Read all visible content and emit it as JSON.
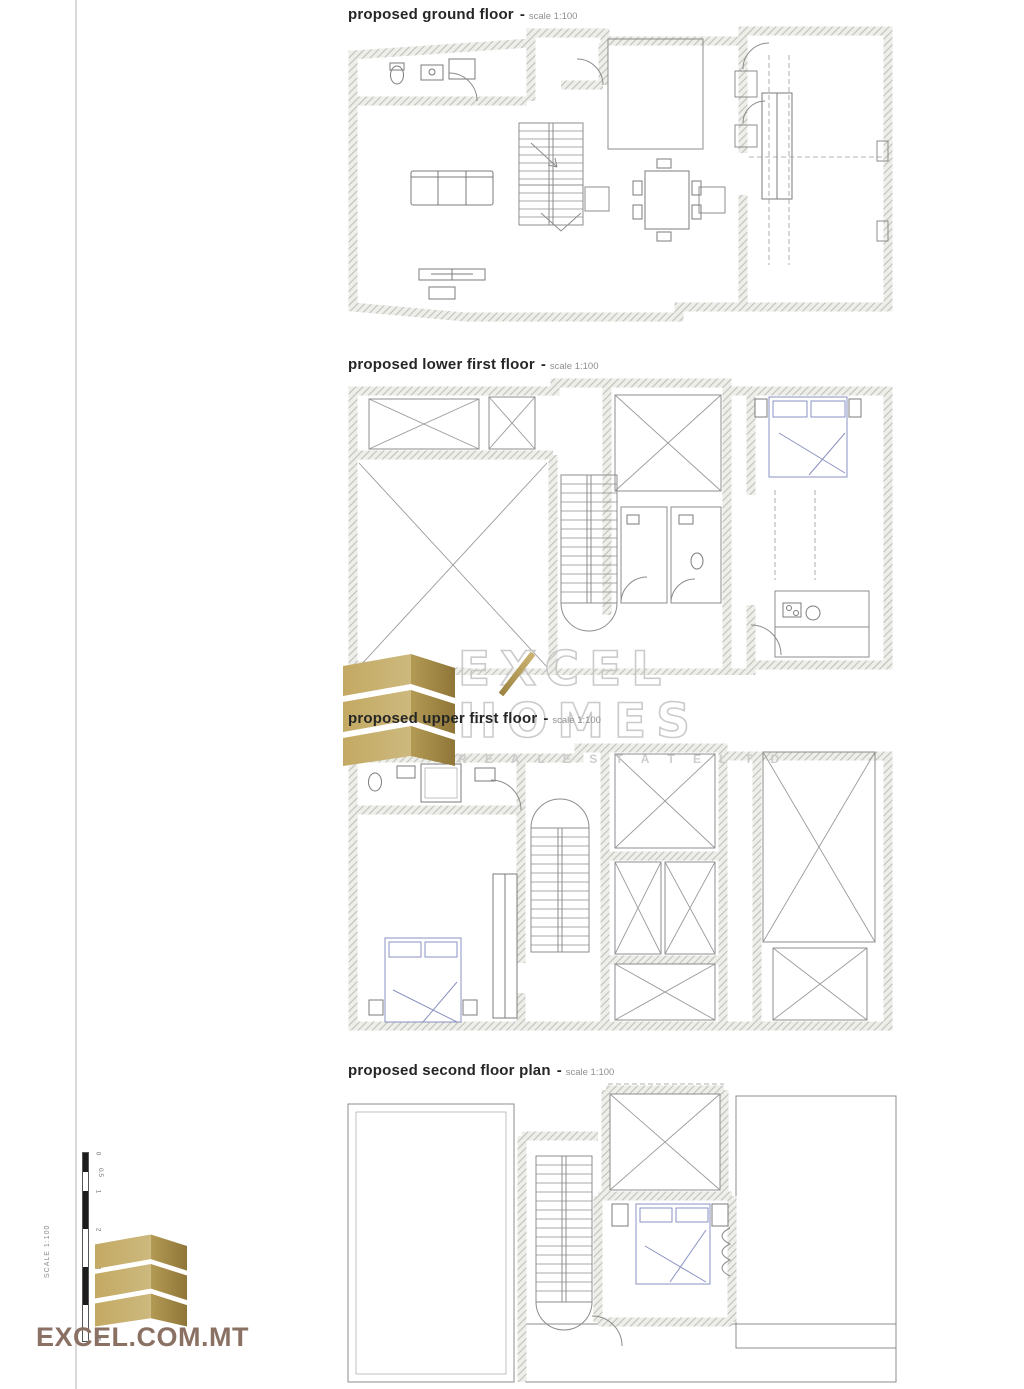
{
  "labels": {
    "separator": "-"
  },
  "plans": [
    {
      "title": "proposed ground floor",
      "scale": "scale 1:100"
    },
    {
      "title": "proposed lower first floor",
      "scale": "scale 1:100"
    },
    {
      "title": "proposed upper first floor",
      "scale": "scale 1:100"
    },
    {
      "title": "proposed second floor plan",
      "scale": "scale 1:100"
    }
  ],
  "watermark": {
    "word1": "EXCEL",
    "word2": "HOMES",
    "tagline": "R E A L   E S T A T E   L T D"
  },
  "footer": {
    "website": "EXCEL.COM.MT",
    "scalebar": {
      "caption": "SCALE 1:100",
      "ticks": [
        "0",
        "0.5",
        "1",
        "2",
        "3",
        "5"
      ]
    }
  },
  "colors": {
    "gold_light": "#cdb472",
    "gold_dark": "#9b8340",
    "watermark_gray": "#c6c6c6",
    "website_brown": "#8a7164",
    "title_dark": "#262626",
    "scale_gray": "#8f8f8f"
  }
}
